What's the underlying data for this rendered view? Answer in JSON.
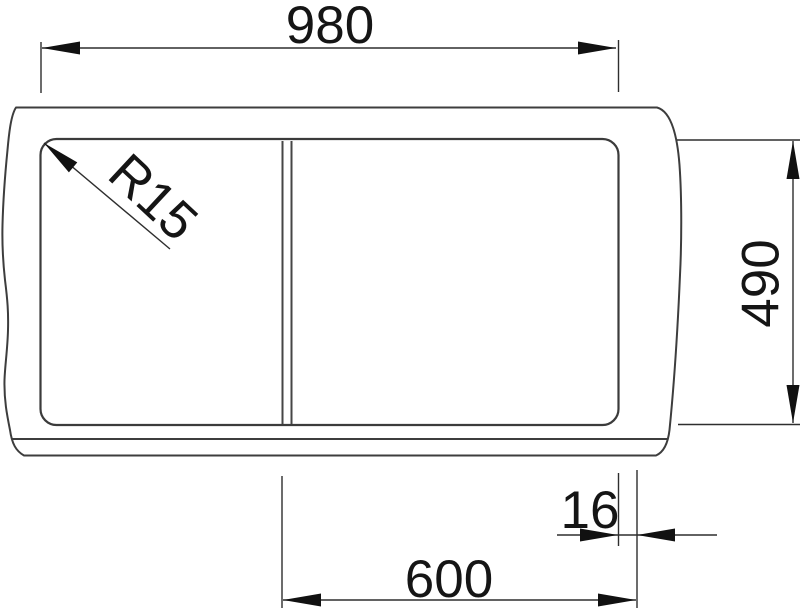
{
  "drawing": {
    "kind": "technical-dimension-drawing",
    "subject": "sink-top-view",
    "colors": {
      "background": "#ffffff",
      "outline": "#3d3d3d",
      "dimension_lines": "#2e2e2e",
      "text": "#151515"
    },
    "dimensions": {
      "top_width": "980",
      "right_depth": "490",
      "bottom_width": "600",
      "bottom_gap": "16",
      "corner_radius": "R15"
    }
  }
}
